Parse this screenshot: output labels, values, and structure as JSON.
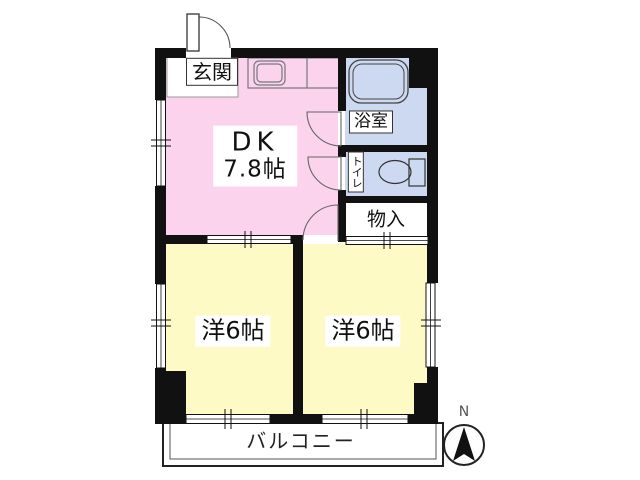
{
  "colors": {
    "wall": "#111111",
    "dk_pink": "#fbd3ec",
    "room_yellow": "#fdfac6",
    "wet_area_blue": "#cdd9f1",
    "fixture_stroke": "#77777f"
  },
  "rooms": {
    "entrance": {
      "label": "玄関"
    },
    "dk": {
      "name": "DK",
      "size": "7.8帖"
    },
    "bath": {
      "label": "浴室"
    },
    "toilet": {
      "label": "トイレ"
    },
    "storage": {
      "label": "物入"
    },
    "bedroom_left": {
      "label": "洋6帖"
    },
    "bedroom_right": {
      "label": "洋6帖"
    },
    "balcony": {
      "label": "バルコニー"
    }
  },
  "compass": {
    "north": "N"
  },
  "icons": {
    "kitchen_sink": "kitchen-sink-icon",
    "bathtub": "bathtub-icon",
    "toilet": "toilet-icon",
    "north_arrow": "north-arrow-icon",
    "entrance_door": "entrance-door-swing-icon"
  }
}
